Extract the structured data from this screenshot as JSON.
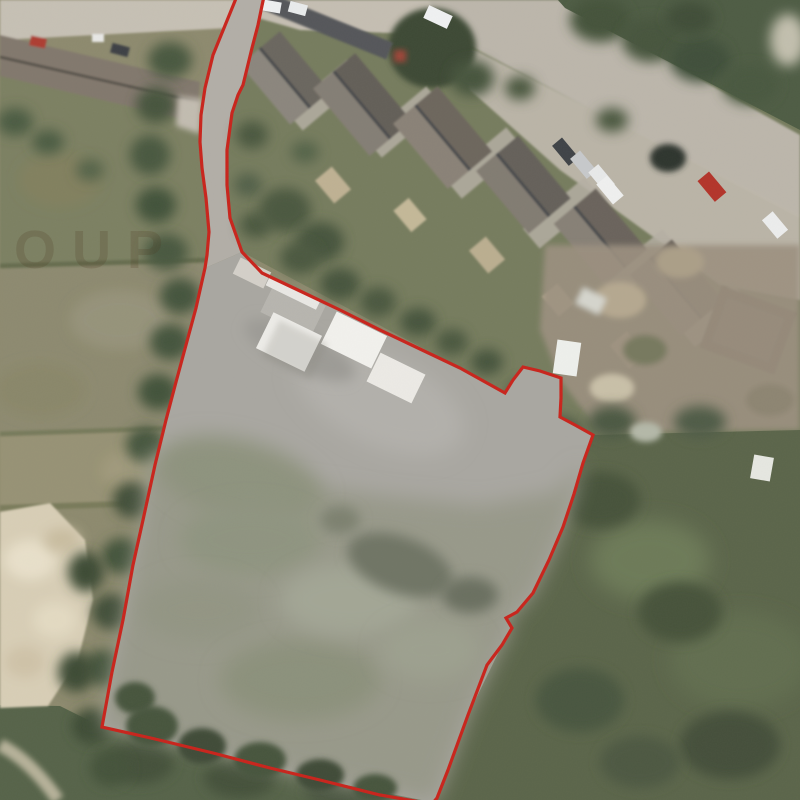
{
  "watermark": {
    "text": "OUP"
  },
  "boundary": {
    "color": "#c9241c"
  },
  "palette": {
    "road": "#bcb6ab",
    "pavement": "#c3bcb1",
    "roof_dark": "#6e6861",
    "tree_dark": "#47553d",
    "garden_green": "#767c5e",
    "field_olive": "#8d8a6e",
    "site_yard": "#a9a7a1",
    "site_grass": "#98998a",
    "sand": "#d8ceb6",
    "container_white": "#f0efec",
    "car_red": "#b3342a"
  }
}
